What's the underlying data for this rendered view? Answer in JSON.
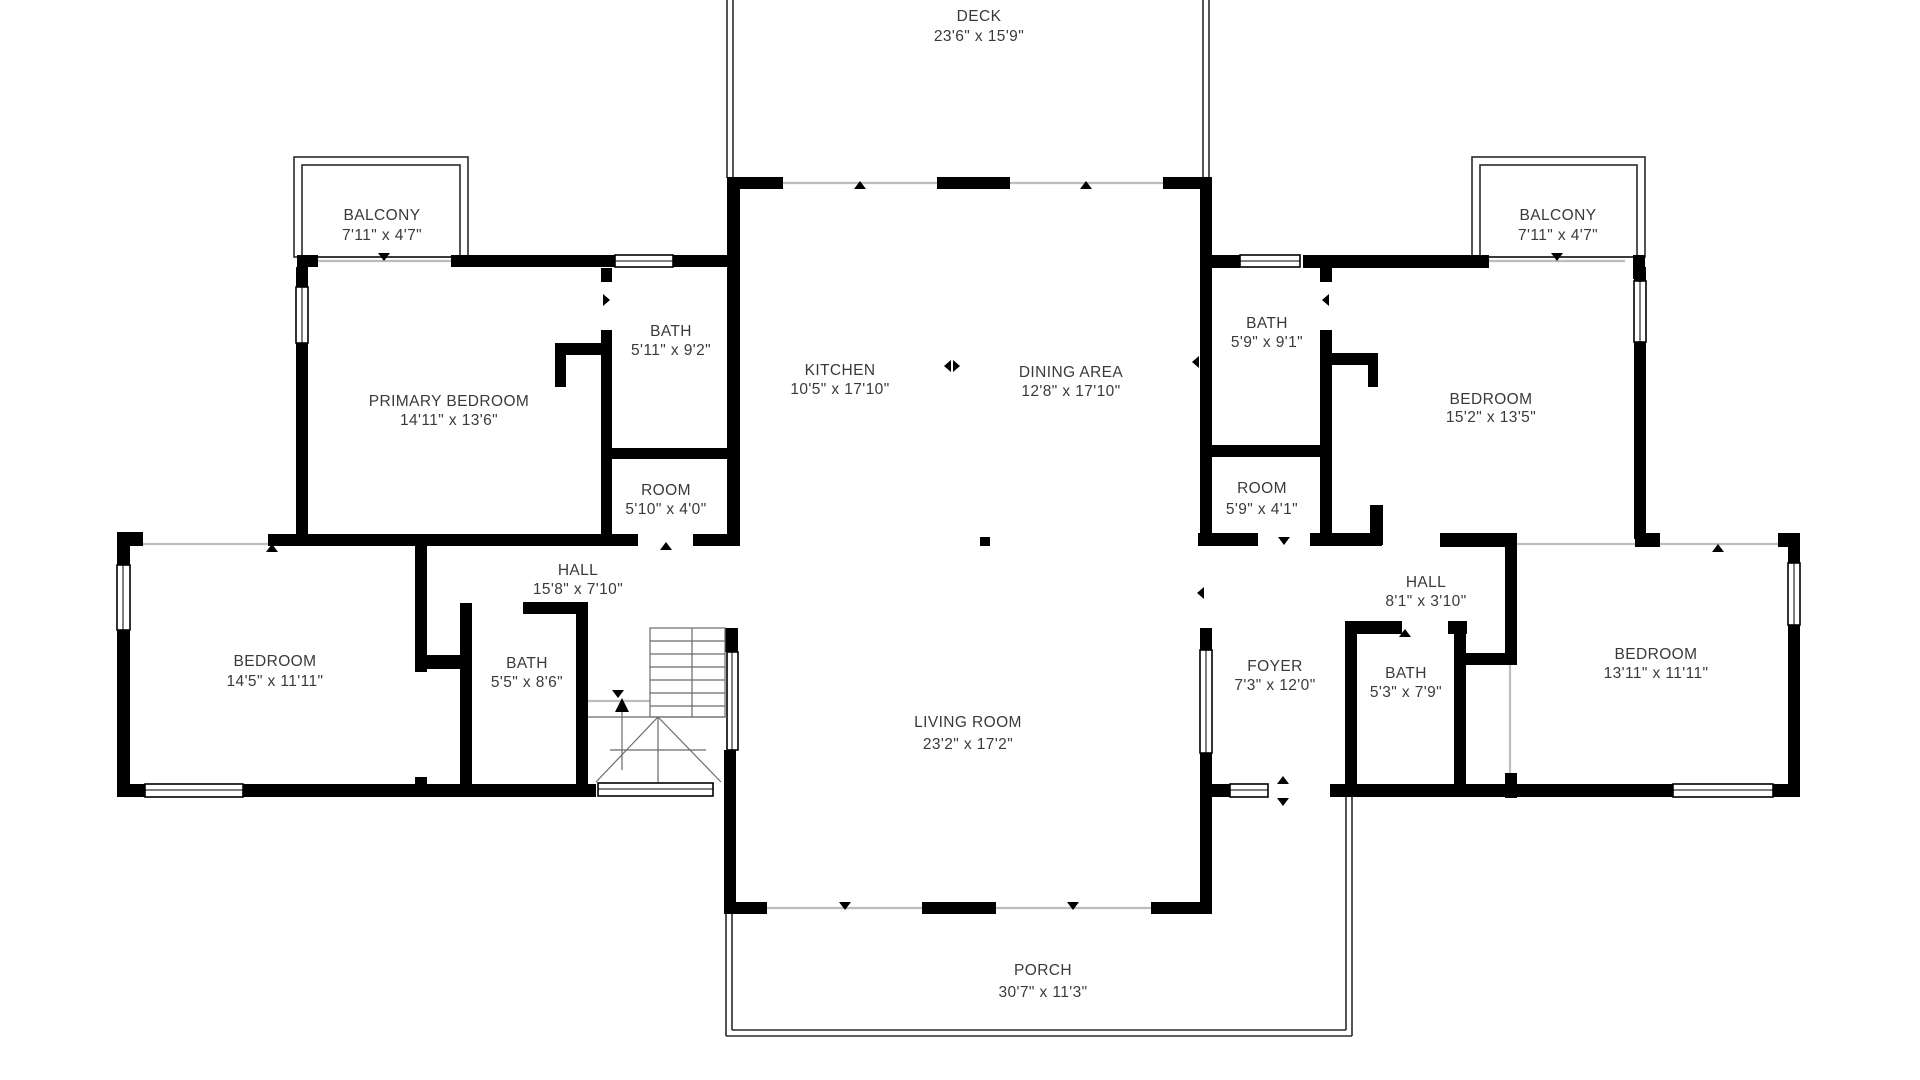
{
  "page": {
    "type": "floor-plan",
    "background": "#ffffff",
    "wall_color": "#000000",
    "text_color": "#3a3a3a"
  },
  "rooms": {
    "deck": {
      "name": "DECK",
      "dims": "23'6\" x 15'9\""
    },
    "balcony_left": {
      "name": "BALCONY",
      "dims": "7'11\" x 4'7\""
    },
    "balcony_right": {
      "name": "BALCONY",
      "dims": "7'11\" x 4'7\""
    },
    "bath_upper_left": {
      "name": "BATH",
      "dims": "5'11\" x 9'2\""
    },
    "primary_bedroom": {
      "name": "PRIMARY BEDROOM",
      "dims": "14'11\" x 13'6\""
    },
    "kitchen": {
      "name": "KITCHEN",
      "dims": "10'5\" x 17'10\""
    },
    "dining_area": {
      "name": "DINING AREA",
      "dims": "12'8\" x 17'10\""
    },
    "bath_upper_right": {
      "name": "BATH",
      "dims": "5'9\" x 9'1\""
    },
    "bedroom_upper_right": {
      "name": "BEDROOM",
      "dims": "15'2\" x 13'5\""
    },
    "room_left": {
      "name": "ROOM",
      "dims": "5'10\" x 4'0\""
    },
    "room_right": {
      "name": "ROOM",
      "dims": "5'9\" x 4'1\""
    },
    "hall_left": {
      "name": "HALL",
      "dims": "15'8\" x 7'10\""
    },
    "hall_right": {
      "name": "HALL",
      "dims": "8'1\" x 3'10\""
    },
    "bedroom_left": {
      "name": "BEDROOM",
      "dims": "14'5\" x 11'11\""
    },
    "bath_left": {
      "name": "BATH",
      "dims": "5'5\" x 8'6\""
    },
    "living_room": {
      "name": "LIVING ROOM",
      "dims": "23'2\" x 17'2\""
    },
    "foyer": {
      "name": "FOYER",
      "dims": "7'3\" x 12'0\""
    },
    "bath_lower_right": {
      "name": "BATH",
      "dims": "5'3\" x 7'9\""
    },
    "bedroom_right": {
      "name": "BEDROOM",
      "dims": "13'11\" x 11'11\""
    },
    "porch": {
      "name": "PORCH",
      "dims": "30'7\" x 11'3\""
    }
  }
}
